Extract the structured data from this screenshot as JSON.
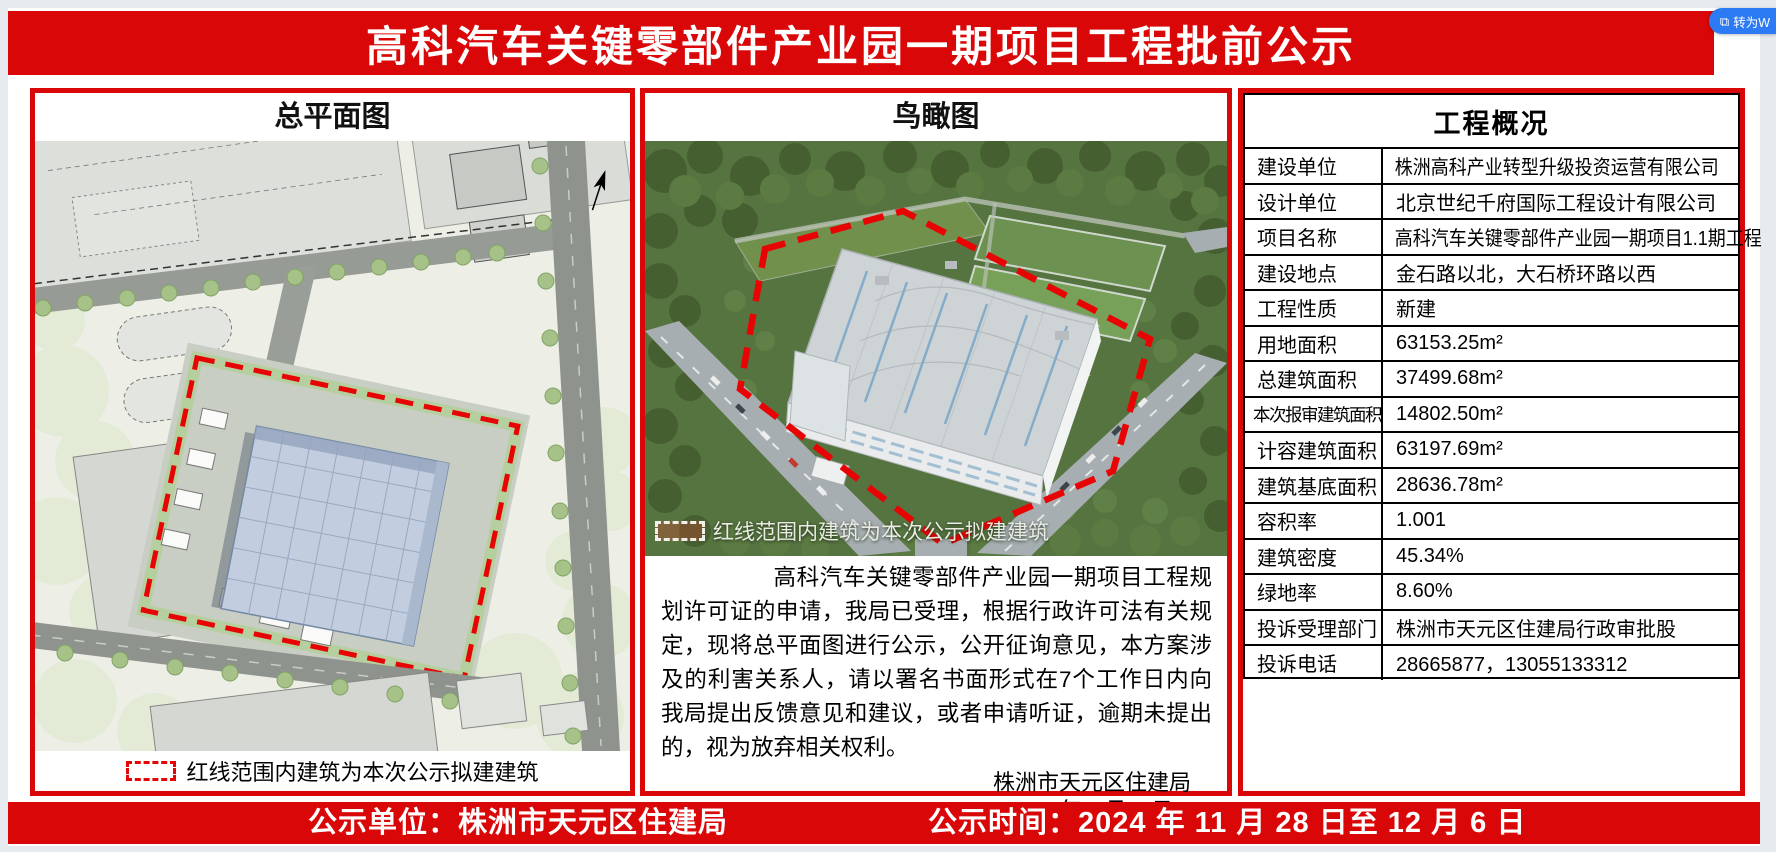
{
  "ui": {
    "convert_button": "转为W",
    "convert_icon": "⧉"
  },
  "banner": {
    "title": "高科汽车关键零部件产业园一期项目工程批前公示"
  },
  "site_plan": {
    "title": "总平面图",
    "legend": "红线范围内建筑为本次公示拟建建筑"
  },
  "aerial": {
    "title": "鸟瞰图",
    "legend": "红线范围内建筑为本次公示拟建建筑",
    "notice": "高科汽车关键零部件产业园一期项目工程规划许可证的申请，我局已受理，根据行政许可法有关规定，现将总平面图进行公示，公开征询意见，本方案涉及的利害关系人，请以署名书面形式在7个工作日内向我局提出反馈意见和建议，或者申请听证，逾期未提出的，视为放弃相关权利。",
    "signature": "株洲市天元区住建局",
    "date": "2024年11月28日"
  },
  "overview": {
    "title": "工程概况",
    "rows": [
      {
        "label": "建设单位",
        "value": "株洲高科产业转型升级投资运营有限公司"
      },
      {
        "label": "设计单位",
        "value": "北京世纪千府国际工程设计有限公司"
      },
      {
        "label": "项目名称",
        "value": "高科汽车关键零部件产业园一期项目1.1期工程"
      },
      {
        "label": "建设地点",
        "value": "金石路以北，大石桥环路以西"
      },
      {
        "label": "工程性质",
        "value": "新建"
      },
      {
        "label": "用地面积",
        "value": "63153.25m²"
      },
      {
        "label": "总建筑面积",
        "value": "37499.68m²"
      },
      {
        "label": "本次报审建筑面积",
        "value": "14802.50m²"
      },
      {
        "label": "计容建筑面积",
        "value": "63197.69m²"
      },
      {
        "label": "建筑基底面积",
        "value": "28636.78m²"
      },
      {
        "label": "容积率",
        "value": "1.001"
      },
      {
        "label": "建筑密度",
        "value": "45.34%"
      },
      {
        "label": "绿地率",
        "value": "8.60%"
      },
      {
        "label": "投诉受理部门",
        "value": "株洲市天元区住建局行政审批股"
      },
      {
        "label": "投诉电话",
        "value": "28665877，13055133312"
      }
    ]
  },
  "footer": {
    "publisher": "公示单位：株洲市天元区住建局",
    "period": "公示时间：2024 年 11 月 28 日至 12 月 6 日"
  },
  "colors": {
    "accent_red": "#d90707",
    "button_blue": "#2d7bf4"
  }
}
